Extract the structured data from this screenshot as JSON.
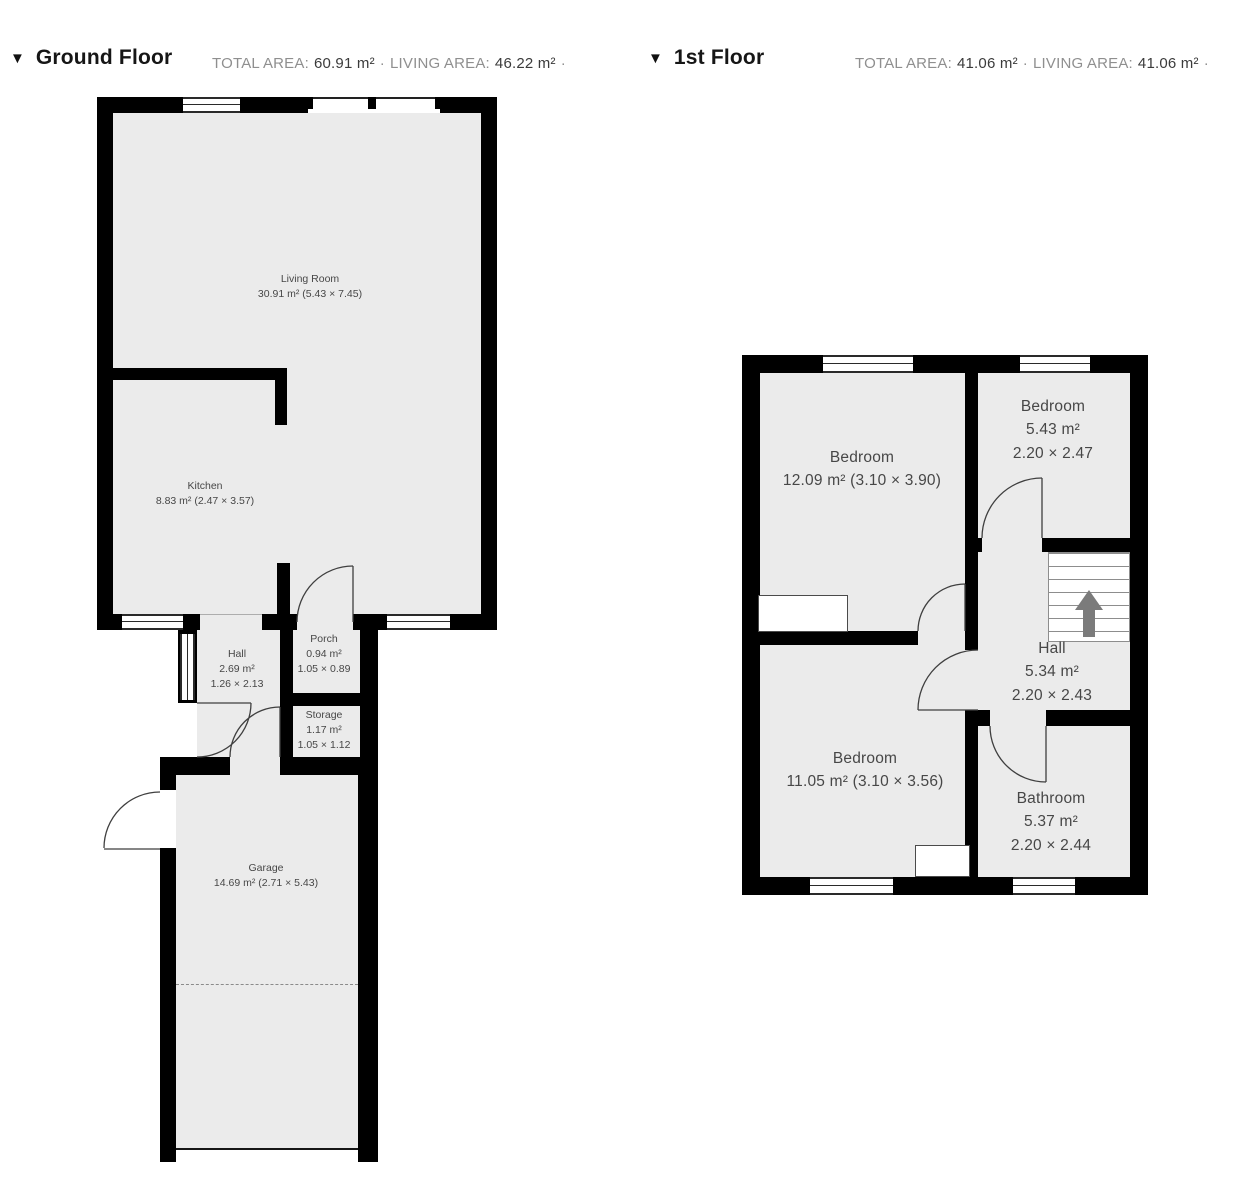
{
  "colors": {
    "wall": "#000000",
    "room_fill": "#ebebeb",
    "label_text": "#474747",
    "header_title": "#161616",
    "stats_label": "#8f8f8f",
    "stats_value": "#3b3b3b",
    "stairs_arrow": "#7b7b7b"
  },
  "floors": [
    {
      "marker": "▼",
      "title": "Ground Floor",
      "stats": {
        "total_label": "TOTAL AREA:",
        "total_value": "60.91 m²",
        "dot": "·",
        "living_label": "LIVING AREA:",
        "living_value": "46.22 m²",
        "dot2": "·"
      },
      "rooms": {
        "living_room": {
          "lines": [
            "Living Room",
            "30.91 m² (5.43 × 7.45)"
          ]
        },
        "kitchen": {
          "lines": [
            "Kitchen",
            "8.83 m² (2.47 × 3.57)"
          ]
        },
        "hall": {
          "lines": [
            "Hall",
            "2.69 m²",
            "1.26 × 2.13"
          ]
        },
        "porch": {
          "lines": [
            "Porch",
            "0.94 m²",
            "1.05 × 0.89"
          ]
        },
        "storage": {
          "lines": [
            "Storage",
            "1.17 m²",
            "1.05 × 1.12"
          ]
        },
        "garage": {
          "lines": [
            "Garage",
            "14.69 m² (2.71 × 5.43)"
          ]
        }
      }
    },
    {
      "marker": "▼",
      "title": "1st Floor",
      "stats": {
        "total_label": "TOTAL AREA:",
        "total_value": "41.06 m²",
        "dot": "·",
        "living_label": "LIVING AREA:",
        "living_value": "41.06 m²",
        "dot2": "·"
      },
      "rooms": {
        "bedroom_1": {
          "lines": [
            "Bedroom",
            "12.09 m² (3.10 × 3.90)"
          ]
        },
        "bedroom_2": {
          "lines": [
            "Bedroom",
            "5.43 m²",
            "2.20 × 2.47"
          ]
        },
        "hall": {
          "lines": [
            "Hall",
            "5.34 m²",
            "2.20 × 2.43"
          ]
        },
        "bedroom_3": {
          "lines": [
            "Bedroom",
            "11.05 m² (3.10 × 3.56)"
          ]
        },
        "bathroom": {
          "lines": [
            "Bathroom",
            "5.37 m²",
            "2.20 × 2.44"
          ]
        }
      }
    }
  ]
}
